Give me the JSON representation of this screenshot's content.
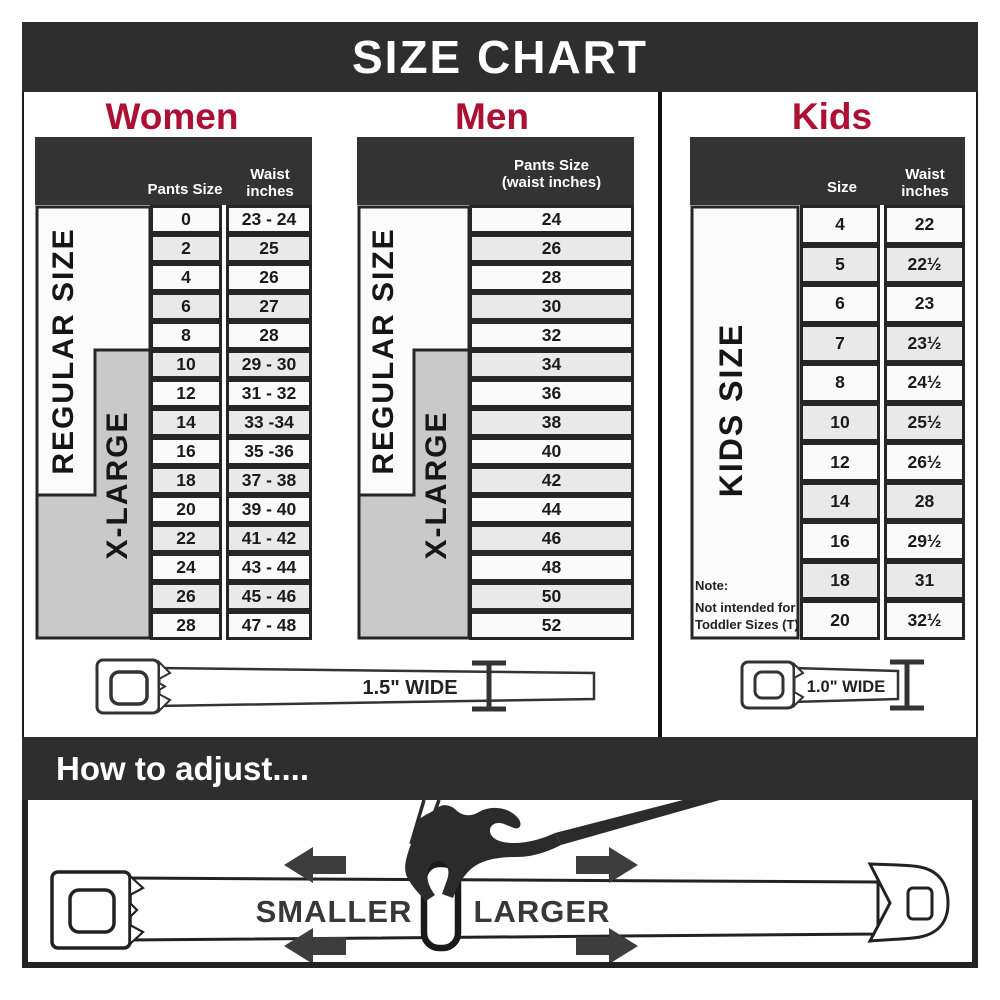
{
  "title": "SIZE CHART",
  "colors": {
    "banner": "#2e2e2e",
    "table_header": "#333333",
    "accent_crimson": "#ad1035",
    "xlarge_gray": "#c9c9c9",
    "row_alt": "#e9e9e9"
  },
  "women": {
    "label": "Women",
    "col_size": "Pants Size",
    "col_waist_line1": "Waist",
    "col_waist_line2": "inches",
    "regular_label": "REGULAR SIZE",
    "xlarge_label": "X-LARGE",
    "rows": [
      {
        "size": "0",
        "waist": "23 - 24"
      },
      {
        "size": "2",
        "waist": "25"
      },
      {
        "size": "4",
        "waist": "26"
      },
      {
        "size": "6",
        "waist": "27"
      },
      {
        "size": "8",
        "waist": "28"
      },
      {
        "size": "10",
        "waist": "29 - 30"
      },
      {
        "size": "12",
        "waist": "31 - 32"
      },
      {
        "size": "14",
        "waist": "33 -34"
      },
      {
        "size": "16",
        "waist": "35 -36"
      },
      {
        "size": "18",
        "waist": "37 - 38"
      },
      {
        "size": "20",
        "waist": "39 - 40"
      },
      {
        "size": "22",
        "waist": "41 - 42"
      },
      {
        "size": "24",
        "waist": "43 - 44"
      },
      {
        "size": "26",
        "waist": "45 - 46"
      },
      {
        "size": "28",
        "waist": "47 - 48"
      }
    ]
  },
  "men": {
    "label": "Men",
    "col_line1": "Pants Size",
    "col_line2": "(waist inches)",
    "regular_label": "REGULAR SIZE",
    "xlarge_label": "X-LARGE",
    "rows": [
      "24",
      "26",
      "28",
      "30",
      "32",
      "34",
      "36",
      "38",
      "40",
      "42",
      "44",
      "46",
      "48",
      "50",
      "52"
    ]
  },
  "kids": {
    "label": "Kids",
    "col_size": "Size",
    "col_waist_line1": "Waist",
    "col_waist_line2": "inches",
    "side_label": "KIDS SIZE",
    "note_line1": "Note:",
    "note_line2": "Not intended for",
    "note_line3": "Toddler Sizes (T)",
    "rows": [
      {
        "size": "4",
        "waist": "22"
      },
      {
        "size": "5",
        "waist": "22½"
      },
      {
        "size": "6",
        "waist": "23"
      },
      {
        "size": "7",
        "waist": "23½"
      },
      {
        "size": "8",
        "waist": "24½"
      },
      {
        "size": "10",
        "waist": "25½"
      },
      {
        "size": "12",
        "waist": "26½"
      },
      {
        "size": "14",
        "waist": "28"
      },
      {
        "size": "16",
        "waist": "29½"
      },
      {
        "size": "18",
        "waist": "31"
      },
      {
        "size": "20",
        "waist": "32½"
      }
    ]
  },
  "belts": {
    "adult_width_label": "1.5\" WIDE",
    "kids_width_label": "1.0\" WIDE"
  },
  "adjust": {
    "title": "How to adjust....",
    "smaller_label": "SMALLER",
    "larger_label": "LARGER"
  }
}
